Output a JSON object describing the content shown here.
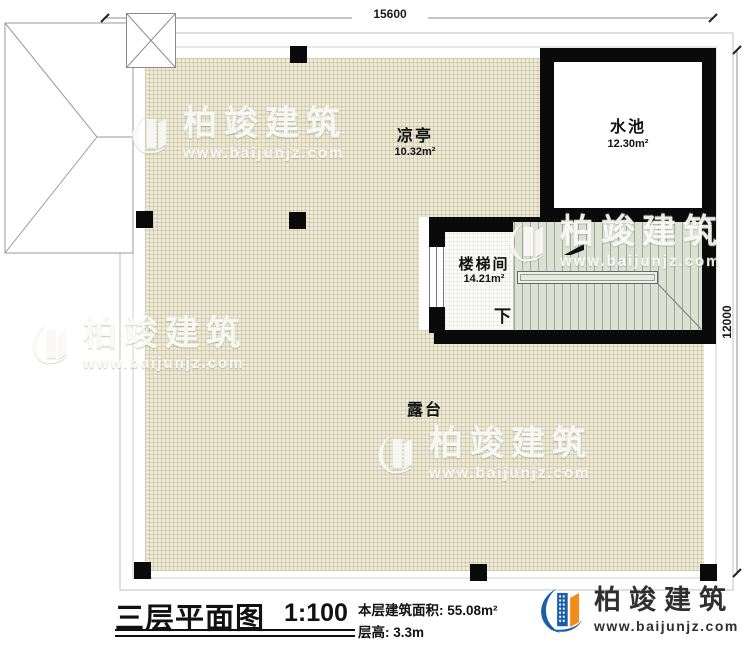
{
  "dimensions": {
    "top": "15600",
    "right": "12000"
  },
  "rooms": {
    "pavilion": {
      "name": "凉亭",
      "area": "10.32m²"
    },
    "pool": {
      "name": "水池",
      "area": "12.30m²"
    },
    "stairwell": {
      "name": "楼梯间",
      "area": "14.21m²"
    },
    "terrace": {
      "name": "露台"
    }
  },
  "stairs": {
    "direction": "下"
  },
  "title_block": {
    "title": "三层平面图",
    "scale": "1:100",
    "floor_area": "本层建筑面积: 55.08m²",
    "floor_height": "层高: 3.3m"
  },
  "brand": {
    "name": "柏竣建筑",
    "url": "www.baijunjz.com"
  },
  "watermark": {
    "brand": "柏竣建筑",
    "url": "www.baijunjz.com"
  },
  "colors": {
    "wall": "#0a0a0a",
    "terrace_fill": "#edead9",
    "stair_fill": "#dce1d4",
    "brand_blue": "#1a5fa8",
    "brand_orange": "#f28a1c"
  }
}
